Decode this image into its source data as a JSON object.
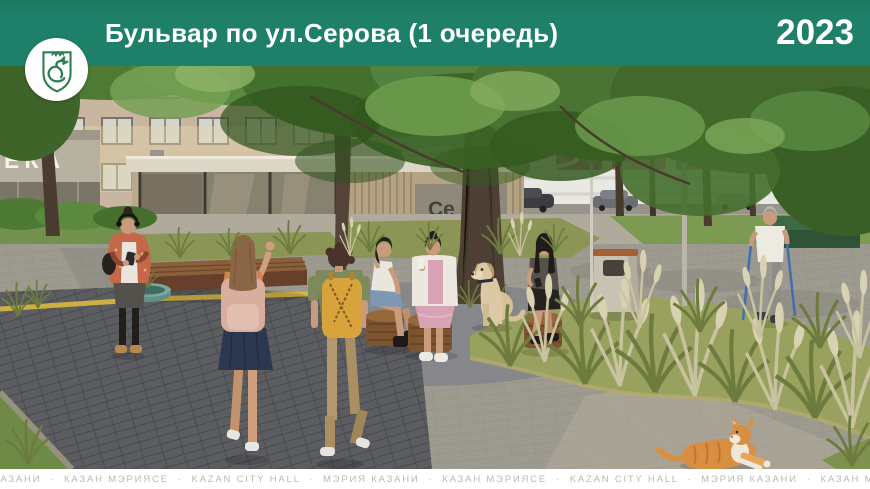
{
  "header": {
    "title": "Бульвар по ул.Серова (1 очередь)",
    "year": "2023",
    "background_color": "#1e8068",
    "text_color": "#ffffff"
  },
  "logo": {
    "emblem": "zilant-dragon-coat-of-arms-of-kazan",
    "emblem_color": "#2e7d52",
    "background_color": "#ffffff"
  },
  "scene": {
    "left_building_sign": "ЕКА",
    "pavilion_sign_line1": "Се",
    "pavilion_sign_line2": "рова",
    "elements": [
      "brick apartment building",
      "pharmacy sign fragment",
      "park pavilion with glass front",
      "white circular canopy ring",
      "street trees",
      "ornamental grass beds",
      "gray paver plaza",
      "dark paver walkway with yellow tactile strip",
      "round wooden benches",
      "long wooden bench",
      "concrete litter bin",
      "street lamps",
      "pink shop sign band",
      "parked cars",
      "green bench box"
    ],
    "people": [
      "woman walking with phone and headphones",
      "girl with pink backpack waving",
      "boy with yellow backpack",
      "woman in white top and denim skirt sitting",
      "woman in pink dress and white cardigan sitting",
      "woman in gray top sitting with phone",
      "labrador dog sitting",
      "elderly woman nordic walking",
      "ginger cat lying on path"
    ]
  },
  "footer": {
    "items": [
      "МЭРИЯ КАЗАНИ",
      "КАЗАН МЭРИЯСЕ",
      "KAZAN CITY HALL",
      "МЭРИЯ КАЗАНИ",
      "КАЗАН МЭРИЯСЕ",
      "KAZAN CITY HALL",
      "МЭРИЯ КАЗАНИ",
      "КАЗАН МЭРИЯСЕ"
    ],
    "separator": "·",
    "text_color": "#b9b9b4"
  },
  "palette": {
    "header_green": "#1e8068",
    "tactile_strip_yellow": "#d7b83e",
    "sign_pink": "#d23f98",
    "pavement_dark": "#5b5d61",
    "foliage_green": "#4f7c36"
  }
}
